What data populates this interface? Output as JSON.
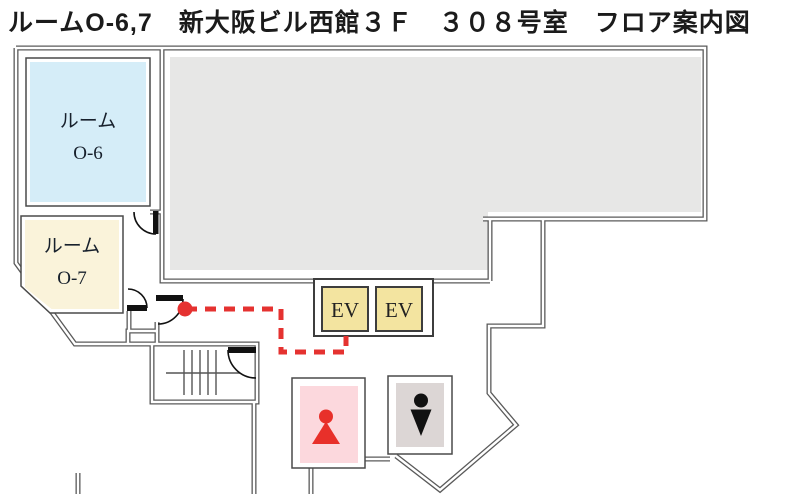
{
  "title": "ルームO-6,7　新大阪ビル西館３Ｆ　３０８号室　フロア案内図",
  "rooms": {
    "o6": {
      "name_line1": "ルーム",
      "name_line2": "O-6"
    },
    "o7": {
      "name_line1": "ルーム",
      "name_line2": "O-7"
    }
  },
  "elevators": {
    "left_label": "EV",
    "right_label": "EV"
  },
  "icons": {
    "female_restroom": "female-restroom-icon",
    "male_restroom": "male-restroom-icon"
  },
  "colors": {
    "room_o6_fill": "#d5edf8",
    "room_o7_fill": "#faf3da",
    "elevator_fill": "#f3e4a0",
    "tenant_area_fill": "#e7e7e6",
    "female_restroom_fill": "#fcd8dd",
    "female_icon": "#e8302a",
    "male_restroom_fill": "#dcd6d5",
    "male_icon": "#111111",
    "route": "#e53230",
    "wall": "#5a5a5a"
  }
}
